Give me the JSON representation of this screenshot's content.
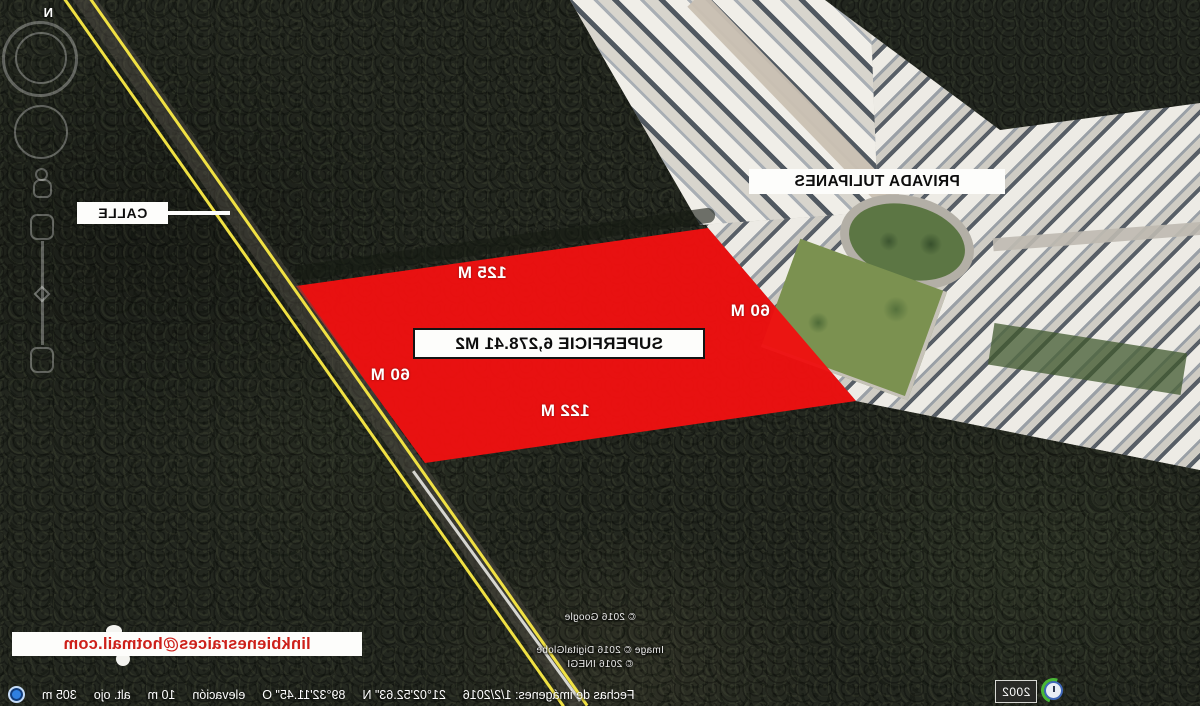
{
  "presentation": {
    "mirrored_capture": true
  },
  "compass": {
    "north_label": "N"
  },
  "street_annotation": {
    "label": "CALLE"
  },
  "neighborhood_annotation": {
    "label": "PRIVADA TULIPANES"
  },
  "parcel_annotation": {
    "area_label": "SUPERFICIE 6,278.41 M2",
    "top_side": "125 M",
    "right_side": "60 M",
    "left_side": "60 M",
    "bottom_side": "122 M",
    "fill_color": "#ee1111"
  },
  "contact_annotation": {
    "email": "linkbienesraices@hotmail.com",
    "text_color": "#cd201a"
  },
  "attribution": {
    "lines": [
      "© 2016 Google",
      "Image © 2016 DigitalGlobe",
      "© 2016 INEGI"
    ]
  },
  "status_bar": {
    "items": [
      "Fechas de imágenes: 1/2/2016",
      "21°02'52.63\" N",
      "89°32'11.45\" O",
      "elevación",
      "10 m",
      "alt. ojo",
      "305 m"
    ]
  },
  "time_indicator": {
    "year": "2002"
  },
  "map_colors": {
    "road_line_yellow": "#f0e143",
    "forest_base": "#23271f",
    "houses_light": "#edebe5"
  }
}
